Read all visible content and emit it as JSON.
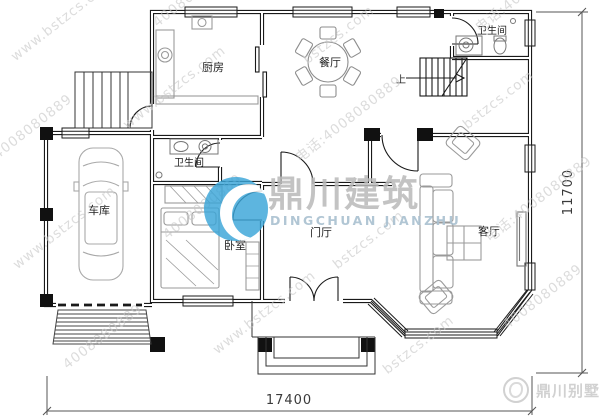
{
  "rooms": {
    "kitchen": "厨房",
    "dining": "餐厅",
    "bath_top": "卫生间",
    "bath_mid": "卫生间",
    "garage": "车库",
    "bedroom": "卧室",
    "foyer": "门厅",
    "living": "客厅"
  },
  "stair": {
    "up": "上"
  },
  "dimensions": {
    "bottom": "17400",
    "right": "11700"
  },
  "watermark": {
    "brand_cn": "鼎川建筑",
    "brand_en": "DINGCHUAN JIANZHU",
    "tiles": [
      "www.bstzcs.com",
      "4008080889",
      "bstzcs.com",
      "电话:4008080889",
      "4008080889",
      "www.bstzcs.com",
      "电话:4008080889",
      "bstzcs.com",
      "www.bstzcs.com",
      "4008080889",
      "bstzcs.com",
      "电话:4008080889",
      "4008080889",
      "www.bstzcs.com",
      "bstzcs.com",
      "4008080889"
    ]
  },
  "badge": {
    "text": "鼎川别墅"
  },
  "colors": {
    "wall": "#1a1a1a",
    "furniture": "#9a9a9a",
    "watermark_gray": "#c7c7c7",
    "logo_blue": "#3aa5d8",
    "brand_gray": "#b9b9b9",
    "brand_en_blue": "#a9c0d0"
  }
}
